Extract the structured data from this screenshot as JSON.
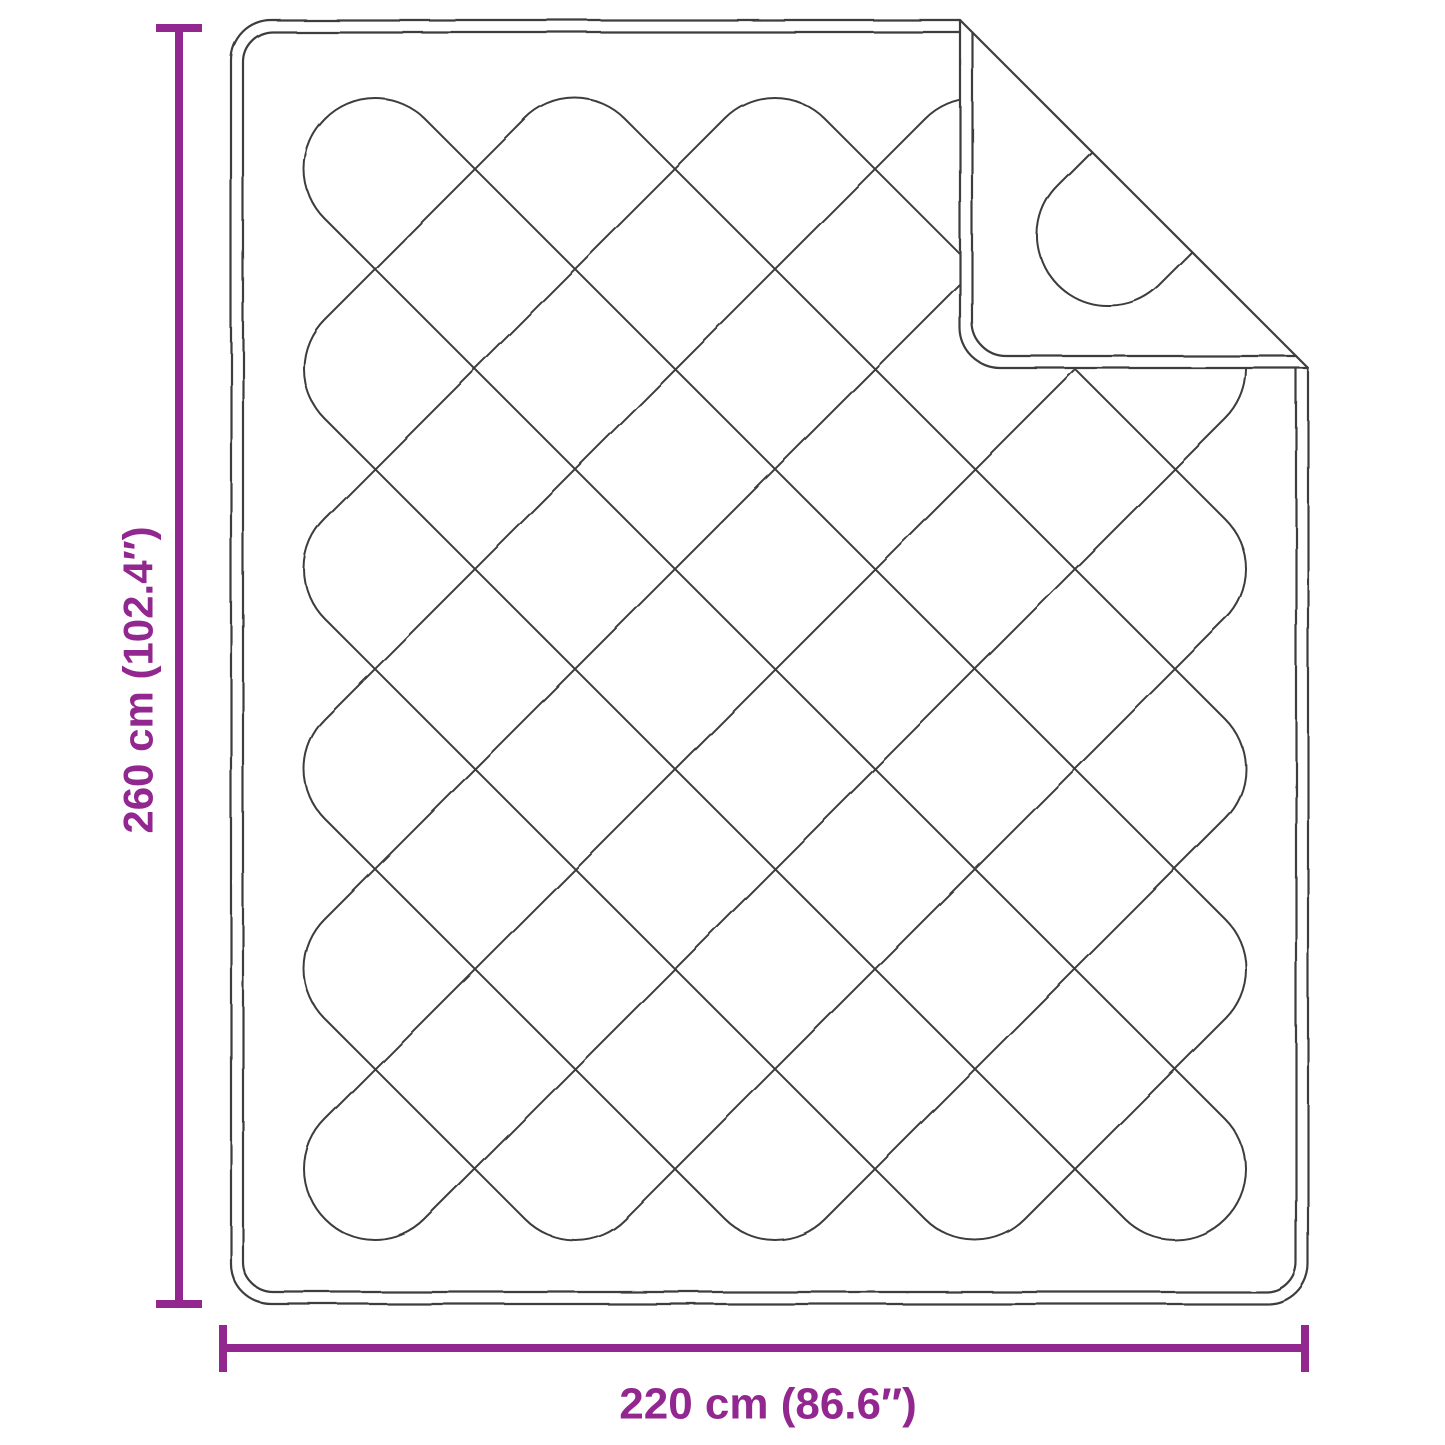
{
  "diagram": {
    "height_dimension": {
      "label": "260 cm (102.4″)"
    },
    "width_dimension": {
      "label": "220 cm (86.6″)"
    }
  },
  "colors": {
    "accent": "#92278F",
    "outline": "#3D3D3D",
    "background": "#FFFFFF"
  }
}
